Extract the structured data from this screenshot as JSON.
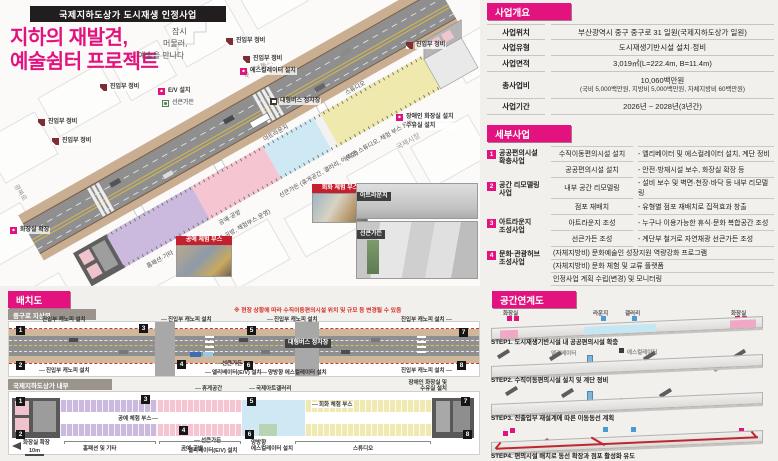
{
  "kicker": "국제지하도상가 도시재생 인정사업",
  "title": {
    "line1": "지하의 재발견,",
    "line2": "예술쉼터 프로젝트"
  },
  "tagline": {
    "l1": "잠시",
    "l2": "머물러,",
    "l3": "예술을 만나다"
  },
  "iso": {
    "streets": {
      "top": "부평깡통시장",
      "right": "국제시장",
      "left": "광복로"
    },
    "callouts": {
      "entry": "진입부 정비",
      "ev": "E/V 설치",
      "sunken_point": "선큰가든",
      "escalator": "에스컬레이터 설치",
      "bus_stop": "대형버스 정차장",
      "toilet_expand": "화장실 확장",
      "disabled_toilet": "장애인 화장실 설치",
      "nursing": "수유실 설치"
    },
    "zones": {
      "homefashion": "홈패션·기타",
      "craft": "공예·공방",
      "craft_sub": "(공예·공방, 체험부스 운영)",
      "sunken": "선큰가든 (휴게공간, 갤러리, 아트샵)",
      "artlounge": "아트라운지",
      "studio": "스튜디오",
      "studio_sub": "(작가 스튜디오, 체험 부스 운영)"
    },
    "photos": {
      "craft_booth": "공예 체험 부스",
      "paint_booth": "회화 체험 부스",
      "artlounge": "아트라운지",
      "sunken": "선큰가든"
    }
  },
  "overview": {
    "title": "사업개요",
    "rows": [
      {
        "k": "사업위치",
        "v": "부산광역시 중구 중구로 31 일원(국제지하도상가 일원)"
      },
      {
        "k": "사업유형",
        "v": "도시재생기반시설 설치·정비"
      },
      {
        "k": "사업면적",
        "v": "3,019㎡(L=222.4m, B=11.4m)"
      },
      {
        "k": "총사업비",
        "v": "10,060백만원",
        "v2": "(국비 5,000백만원, 지방비 5,000백만원, 자체지방비 60백만원)"
      },
      {
        "k": "사업기간",
        "v": "2026년 ~ 2028년(3년간)"
      }
    ]
  },
  "detail": {
    "title": "세부사업",
    "groups": [
      {
        "no": "1",
        "name1": "공공편의시설",
        "name2": "확충사업",
        "items": [
          {
            "t": "수직이동편의시설 설치",
            "d": "- 엘리베이터 및 에스컬레이터 설치, 계단 정비"
          },
          {
            "t": "공공편의시설 설치",
            "d": "- 안전·방재시설 보수, 화장실 확장 등"
          }
        ]
      },
      {
        "no": "2",
        "name1": "공간 리모델링",
        "name2": "사업",
        "items": [
          {
            "t": "내부 공간 리모델링",
            "d": "- 설비 보수 및 벽면·천장·바닥 등 내부 리모델링"
          },
          {
            "t": "점포 재배치",
            "d": "- 유형별 점포 재배치로 집적효과 창출"
          }
        ]
      },
      {
        "no": "3",
        "name1": "아트라운지",
        "name2": "조성사업",
        "items": [
          {
            "t": "아트라운지 조성",
            "d": "- 누구나 이용가능한 휴식·문화 복합공간 조성"
          },
          {
            "t": "선큰가든 조성",
            "d": "- 계단부 철거로 자연채광 선큰가든 조성"
          }
        ]
      },
      {
        "no": "4",
        "name1": "문화·관광허브",
        "name2": "조성사업",
        "lines": [
          "(자체지방비) 문화예술인 성장지원 역량강화 프로그램",
          "(자체지방비) 문화 체험 및 교류 플랫폼",
          "인정사업 계획 수립(변경) 및 모니터링"
        ]
      }
    ]
  },
  "layout": {
    "title": "배치도",
    "markers": [
      "1",
      "2",
      "3",
      "4",
      "5",
      "6",
      "7",
      "8"
    ],
    "plan1": {
      "subtitle": "중구로 지상부",
      "note": "※ 현장 상황에 따라 수직이동편의시설 위치 및 규모 등 변경될 수 있음",
      "canopy": "진입부 캐노피 설치",
      "bus": "대형버스 정차장",
      "sunken": "선큰가든",
      "elevator": "엘리베이터(E/V) 설치",
      "escalator": "양방향 에스컬레이터 설치"
    },
    "plan2": {
      "subtitle": "국제지하도상가 내부",
      "toilet": "화장실 확장",
      "homefashion": "홈패션 및 기타",
      "craft": "공예·공방",
      "craft_booth": "공예 체험 부스",
      "sunken": "선큰가든",
      "elevator": "엘리베이터(E/V) 설치",
      "rest": "휴게공간",
      "gallery": "국제아트갤러리",
      "paint_booth": "회화 체험 부스",
      "escalator1": "양방향",
      "escalator2": "에스컬레이터 설치",
      "studio": "스튜디오",
      "disabled1": "장애인 화장실 및",
      "disabled2": "수유실 설치",
      "scale": "10m"
    }
  },
  "linkage": {
    "title": "공간연계도",
    "step1": {
      "caption": "STEP1. 도시재생기반시설 내 공공편의시설 확충",
      "toilet_l": "화장실",
      "lounge": "라운지",
      "gallery": "갤러리",
      "toilet_r": "화장실"
    },
    "step2": {
      "caption": "STEP2. 수직이동편의시설 설치 및 계단 정비",
      "elevator": "엘리베이터",
      "escalator": "에스컬레이터"
    },
    "step3": {
      "caption": "STEP3. 진출입부 재설계에 따른 이동동선 계획"
    },
    "step4": {
      "caption": "STEP4. 편의시설 배치로 동선 확장과 점포 활성화 유도"
    }
  }
}
